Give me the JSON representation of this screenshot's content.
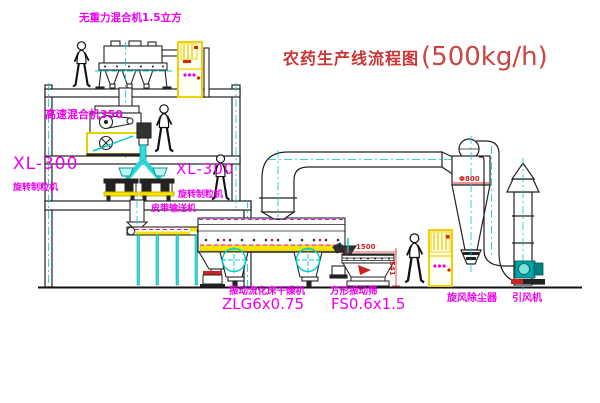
{
  "title": {
    "zh": "农药生产线流程图",
    "capacity": "(500kg/h)"
  },
  "equipment_labels": {
    "top_mixer": "无重力混合机1.5立方",
    "high_speed_mixer": "高速混合机350",
    "granulator_left": {
      "model": "XL-300",
      "name": "旋转制粒机"
    },
    "granulator_right": {
      "model": "XL-300",
      "name": "旋转制粒机"
    },
    "belt_conveyor": "皮带输送机",
    "dryer": {
      "name": "振动流化床干燥机",
      "model": "ZLG6x0.75"
    },
    "screen": {
      "name": "方形振动筛",
      "model": "FS0.6x1.5"
    },
    "cyclone": "旋风除尘器",
    "fan": "引风机"
  },
  "dimensions": {
    "cyclone_diameter": "Φ800",
    "screen_length": "1500",
    "screen_height": "541"
  },
  "colors": {
    "line": "#1a1a1a",
    "centerline_cyan": "#00cccc",
    "label_magenta": "#ee00ee",
    "title_red": "#cc3333",
    "highlight_yellow": "#f5d800"
  }
}
